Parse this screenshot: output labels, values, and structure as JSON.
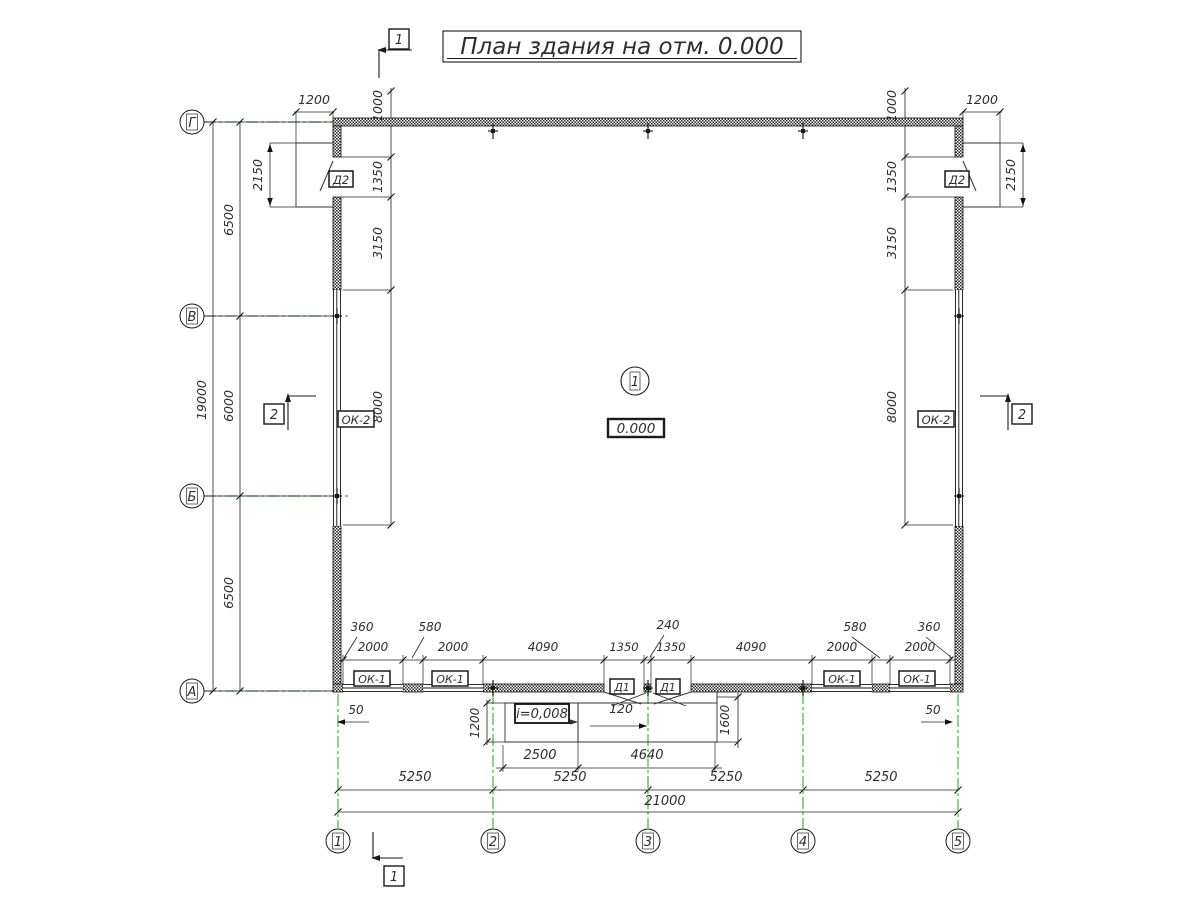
{
  "title": {
    "text": "План здания на отм. 0.000"
  },
  "drawing": {
    "type": "architectural-floor-plan",
    "elevation_mark": "0.000",
    "room_number": "1",
    "slope": "i=0,008"
  },
  "axes": {
    "rows": [
      "Г",
      "В",
      "Б",
      "А"
    ],
    "cols": [
      "1",
      "2",
      "3",
      "4",
      "5"
    ]
  },
  "sections": {
    "s1": "1",
    "s2": "2"
  },
  "tags": {
    "door_side": "Д2",
    "door_main": "Д1",
    "window_strip": "ОК-2",
    "window": "ОК-1"
  },
  "dims": {
    "d50": "50",
    "d120": "120",
    "d240": "240",
    "d360": "360",
    "d580": "580",
    "d1000": "1000",
    "d1200": "1200",
    "d1350": "1350",
    "d1600": "1600",
    "d2000": "2000",
    "d2150": "2150",
    "d2500": "2500",
    "d3150": "3150",
    "d4090": "4090",
    "d4640": "4640",
    "d5250": "5250",
    "d6000": "6000",
    "d6500": "6500",
    "d8000": "8000",
    "d19000": "19000",
    "d21000": "21000"
  },
  "colors": {
    "line": "#222222",
    "axis_green": "#3fb53f",
    "text": "#2e2e2e",
    "wall": "#2b2b2b",
    "background": "#ffffff"
  }
}
